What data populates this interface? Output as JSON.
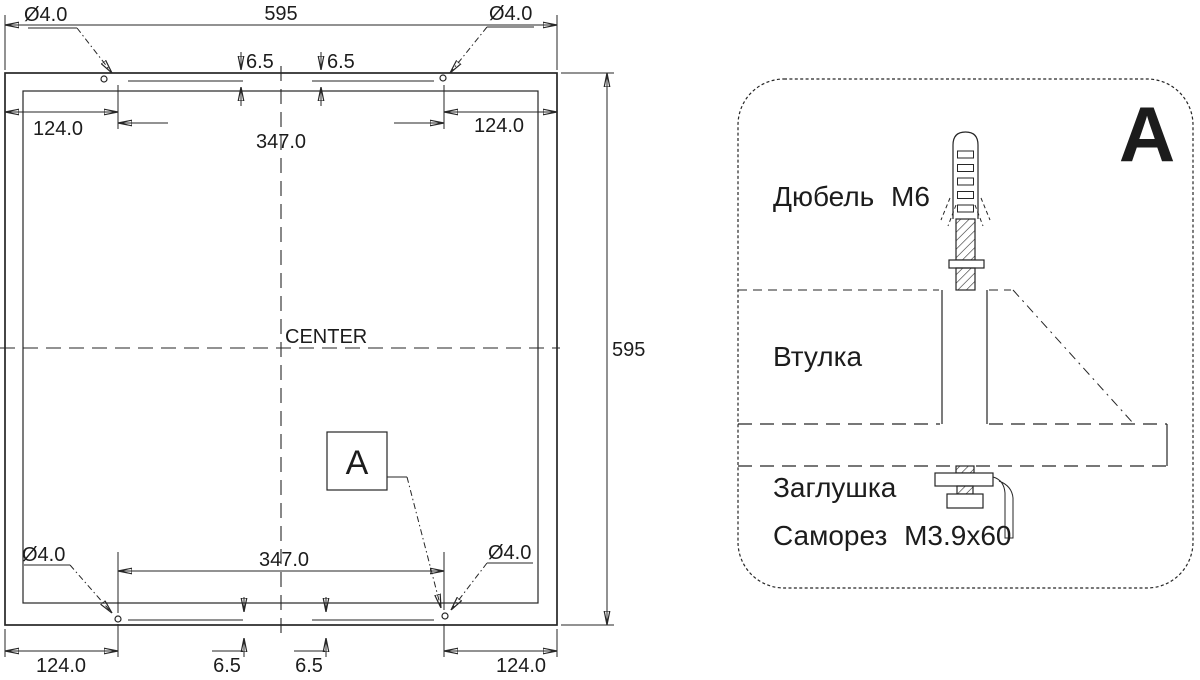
{
  "page": {
    "background": "#ffffff",
    "line_color": "#262626"
  },
  "plan_view": {
    "width_dim": "595",
    "height_dim": "595",
    "hole_diameter": "Ø4.0",
    "hole_spacing": "347.0",
    "edge_offset": "124.0",
    "vertical_offset": "6.5",
    "center_label": "CENTER",
    "detail_marker": "A"
  },
  "detail_view": {
    "title": "A",
    "part_dowel": "Дюбель М6",
    "part_sleeve": "Втулка",
    "part_plug": "Заглушка",
    "part_screw": "Саморез М3.9х60"
  }
}
